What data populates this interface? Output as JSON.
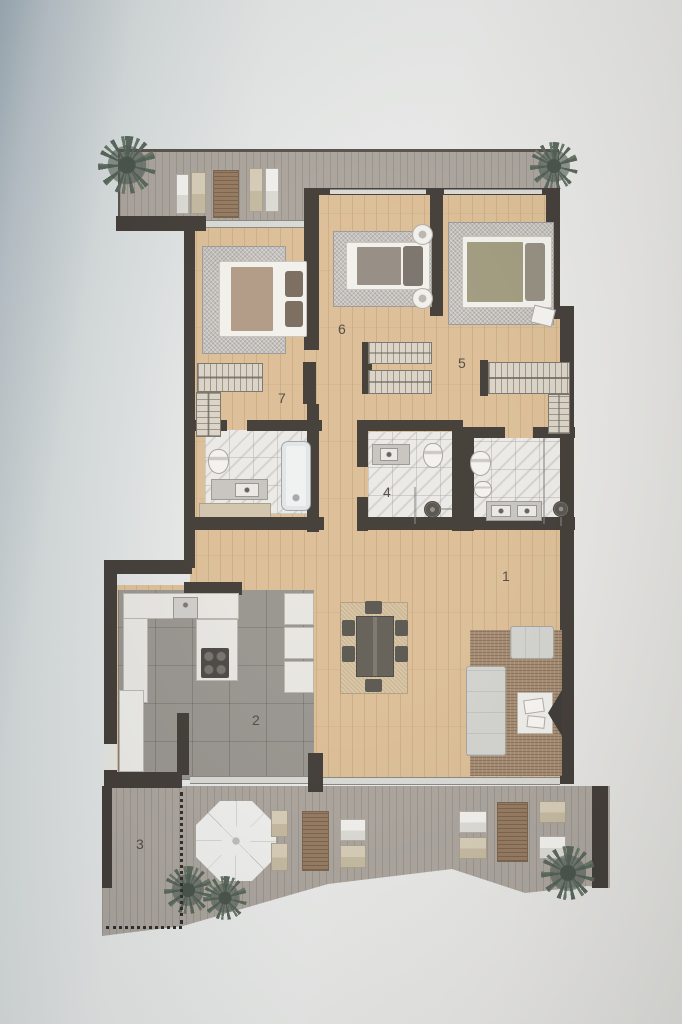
{
  "plan": {
    "title": "apartment-floor-plan",
    "rooms": [
      {
        "id": "living-dining-room",
        "label": "1"
      },
      {
        "id": "kitchen",
        "label": "2"
      },
      {
        "id": "lower-terrace",
        "label": "3"
      },
      {
        "id": "bathroom-main",
        "label": "4"
      },
      {
        "id": "bedroom-right",
        "label": "5"
      },
      {
        "id": "bedroom-middle",
        "label": "6"
      },
      {
        "id": "bedroom-left",
        "label": "7"
      }
    ],
    "colors": {
      "wall": "#332d27",
      "wood_floor": "#d9b98e",
      "terrace_floor": "#a49d95",
      "kitchen_floor": "#908c86",
      "bathroom_floor": "#eae8e3",
      "background": "#e3e5e4",
      "plant": "#4c5a4e",
      "rug_brown": "#9d8164"
    }
  }
}
